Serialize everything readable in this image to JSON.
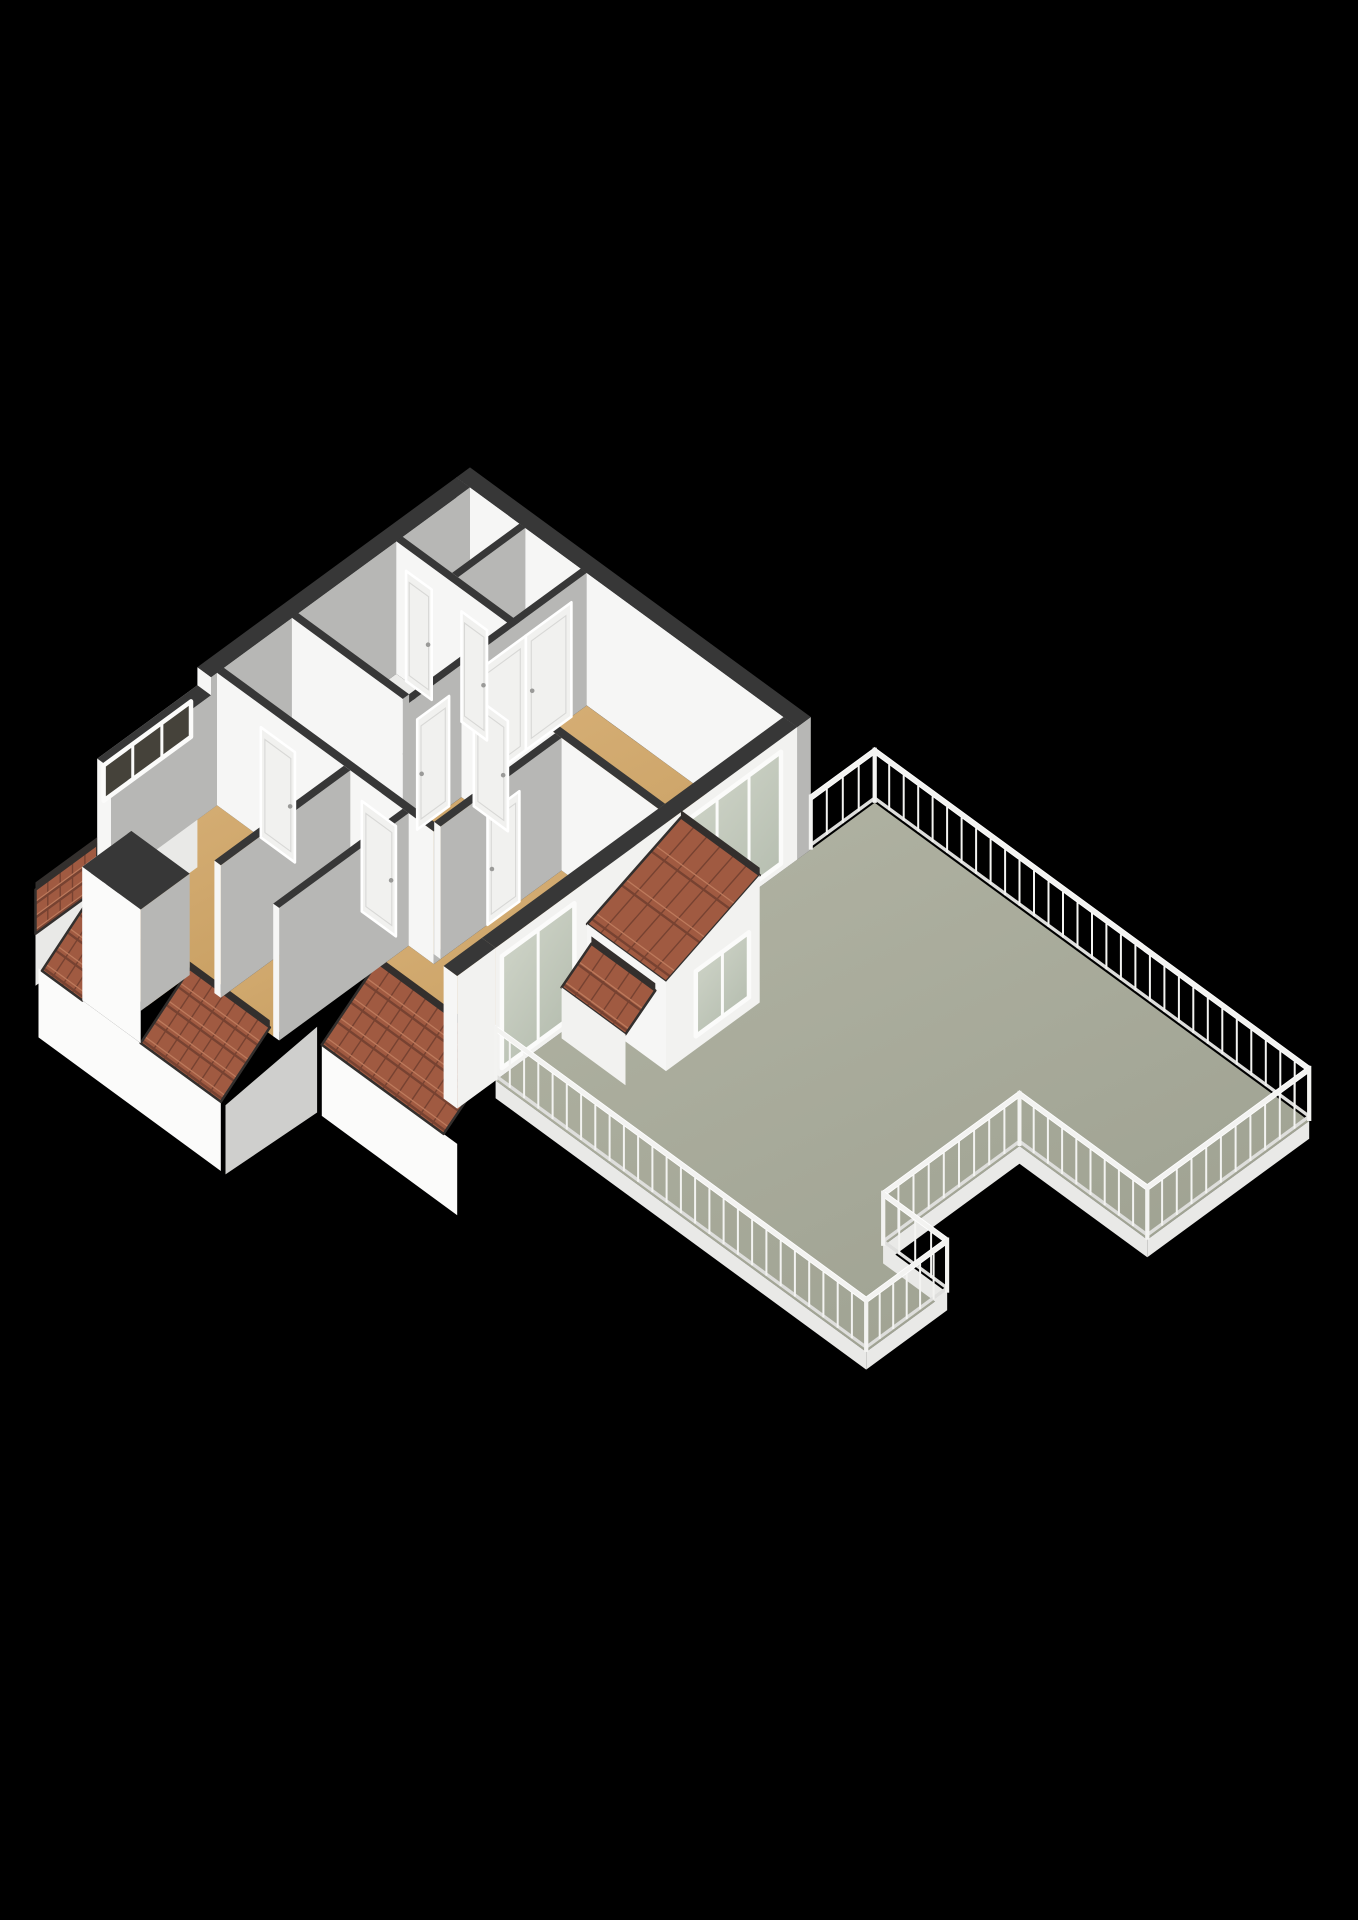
{
  "app": {
    "view_label": "3d-floorplan-render",
    "background": "#000000"
  },
  "projection": {
    "x0": 470,
    "y0": 600,
    "ux": 42.6,
    "uy": 31.2,
    "vz": 52,
    "wall_h": 2.55
  },
  "palette": {
    "bg": "#000000",
    "terrace1": "#b2b4a4",
    "terrace2": "#9fa292",
    "tan1": "#d7b077",
    "tan2": "#c89f62",
    "lightFloor": "#ebebe9",
    "wallTop": "#373737",
    "wallSouth": "#f6f6f5",
    "wallEast": "#b7b7b5",
    "extEast": "#f2f2f0",
    "facadeWhite": "#fbfbfa",
    "facadeGray": "#cfcfcd",
    "fascia": "#e9e9e7",
    "tileBase": "#a05a41",
    "tileDark": "#774231",
    "tileLight": "#bd7a5c",
    "tileTrim": "#332f2d",
    "rail": "#f3f3f1",
    "railShade": "#dededc",
    "glass1": "#d3d8cc",
    "glass2": "#b4bcae",
    "darkGlass": "#45423a",
    "frame": "#fbfbfa",
    "leaf": "#f1f1ef",
    "leafLine": "#d8d8d6",
    "knob": "#9a9a98",
    "hatch": "#f4f4f2",
    "hatchSide": "#dededc",
    "hatchEdge": "#3a3a3a",
    "cubeTop": "#f0f0ee",
    "cubeSouth": "#fafaf8",
    "cubeEast": "#dadad8"
  },
  "terrace": {
    "name": "roof-terrace",
    "outline": [
      [
        8,
        -1.5
      ],
      [
        18.2,
        -1.5
      ],
      [
        18.2,
        2.3
      ],
      [
        15.2,
        2.3
      ],
      [
        15.2,
        5.5
      ],
      [
        16.7,
        5.5
      ],
      [
        16.7,
        7.4
      ],
      [
        8,
        7.4
      ]
    ],
    "fascia_depth": 0.34,
    "fascia_edges": [
      [
        [
          18.2,
          -1.5
        ],
        [
          18.2,
          2.3
        ]
      ],
      [
        [
          18.2,
          2.3
        ],
        [
          15.2,
          2.3
        ]
      ],
      [
        [
          15.2,
          2.3
        ],
        [
          15.2,
          5.5
        ]
      ],
      [
        [
          15.2,
          5.5
        ],
        [
          16.7,
          5.5
        ]
      ],
      [
        [
          16.7,
          5.5
        ],
        [
          16.7,
          7.4
        ]
      ],
      [
        [
          16.7,
          7.4
        ],
        [
          8,
          7.4
        ]
      ]
    ]
  },
  "railing": {
    "spacing": 0.34,
    "z1": 0.94,
    "z2": 1.06,
    "segments": [
      {
        "name": "terrace-railing-nw",
        "a": [
          8,
          -1.5
        ],
        "b": [
          8,
          0
        ]
      },
      {
        "name": "terrace-railing-ne",
        "a": [
          8,
          -1.5
        ],
        "b": [
          18.2,
          -1.5
        ]
      },
      {
        "name": "terrace-railing-east",
        "a": [
          18.2,
          -1.5
        ],
        "b": [
          18.2,
          2.3
        ]
      },
      {
        "name": "terrace-railing-notch-north",
        "a": [
          18.2,
          2.3
        ],
        "b": [
          15.2,
          2.3
        ]
      },
      {
        "name": "terrace-railing-notch-west",
        "a": [
          15.2,
          2.3
        ],
        "b": [
          15.2,
          5.5
        ]
      },
      {
        "name": "terrace-railing-step-north",
        "a": [
          15.2,
          5.5
        ],
        "b": [
          16.7,
          5.5
        ]
      },
      {
        "name": "terrace-railing-step-east",
        "a": [
          16.7,
          5.5
        ],
        "b": [
          16.7,
          7.4
        ]
      },
      {
        "name": "terrace-railing-south",
        "a": [
          16.7,
          7.4
        ],
        "b": [
          8,
          7.4
        ]
      }
    ]
  },
  "floors": [
    {
      "name": "floor-closet-1",
      "color": "lightFloor",
      "rect": [
        0.32,
        0.32,
        1.48,
        1.9
      ]
    },
    {
      "name": "floor-closet-2",
      "color": "lightFloor",
      "rect": [
        1.62,
        0.32,
        2.92,
        1.9
      ]
    },
    {
      "name": "floor-bathroom",
      "color": "lightFloor",
      "rect": [
        0.32,
        2.05,
        2.92,
        4.35
      ]
    },
    {
      "name": "floor-bedroom-ne",
      "color": "tan",
      "rect": [
        3.06,
        0.32,
        7.68,
        3.1
      ]
    },
    {
      "name": "floor-landing",
      "color": "tan",
      "pts": [
        [
          0.32,
          4.5
        ],
        [
          3.06,
          4.5
        ],
        [
          3.06,
          3.26
        ],
        [
          5.26,
          3.26
        ],
        [
          5.26,
          6.1
        ],
        [
          0.32,
          6.1
        ]
      ]
    },
    {
      "name": "floor-bedroom-sw",
      "color": "tan",
      "rect": [
        0.32,
        6.26,
        3.3,
        9.3
      ]
    },
    {
      "name": "floor-dormer-south",
      "color": "tan",
      "rect": [
        1.35,
        9.3,
        2.72,
        10.3
      ]
    },
    {
      "name": "floor-bedroom-smid",
      "color": "tan",
      "rect": [
        3.45,
        6.26,
        4.68,
        9.3
      ]
    },
    {
      "name": "floor-bedroom-se",
      "color": "tan",
      "pts": [
        [
          5.41,
          3.26
        ],
        [
          7.68,
          3.26
        ],
        [
          7.68,
          7.0
        ],
        [
          4.82,
          7.0
        ],
        [
          4.82,
          6.26
        ],
        [
          5.41,
          6.26
        ]
      ]
    }
  ],
  "cube": {
    "name": "storage-unit",
    "rect": [
      1.75,
      0.5,
      2.5,
      1.15
    ],
    "h": 0.8
  },
  "hatch": {
    "name": "stair-hatch",
    "x1": 1.1,
    "y1": 2.3,
    "x2": 2.5,
    "y2": 4.1,
    "zlo": 0.15,
    "zhi": 1.0
  },
  "facades": [
    {
      "name": "facade-west-band-wall",
      "color": "wallSouth",
      "pts": [
        [
          0,
          6.4,
          0
        ],
        [
          0,
          8.75,
          0
        ],
        [
          0,
          8.75,
          2.2
        ],
        [
          0,
          6.4,
          2.2
        ]
      ]
    },
    {
      "name": "facade-west-under-band",
      "color": "fascia",
      "pts": [
        [
          0,
          6.4,
          -1.3
        ],
        [
          0,
          8.75,
          -1.3
        ],
        [
          0,
          8.75,
          0
        ],
        [
          0,
          6.4,
          0
        ]
      ]
    },
    {
      "name": "facade-west-under-tiles",
      "color": "fascia",
      "pts": [
        [
          0,
          8.75,
          -1.3
        ],
        [
          0,
          10.2,
          -1.3
        ],
        [
          0,
          10.2,
          -0.3
        ],
        [
          0,
          8.75,
          -0.3
        ]
      ]
    },
    {
      "name": "facade-south-west",
      "color": "facadeWhite",
      "pts": [
        [
          0.32,
          10.45,
          -0.62
        ],
        [
          4.6,
          10.45,
          -0.62
        ],
        [
          4.6,
          10.45,
          -1.95
        ],
        [
          0.32,
          10.45,
          -1.95
        ]
      ]
    },
    {
      "name": "facade-south-east",
      "color": "facadeWhite",
      "pts": [
        [
          4.82,
          8.3,
          -0.68
        ],
        [
          8.0,
          8.3,
          -0.68
        ],
        [
          8.0,
          8.3,
          -2.05
        ],
        [
          4.82,
          8.3,
          -2.05
        ]
      ]
    },
    {
      "name": "facade-step-side",
      "color": "facadeGray",
      "pts": [
        [
          4.71,
          8.3,
          -0.4
        ],
        [
          4.71,
          10.45,
          -0.62
        ],
        [
          4.71,
          10.45,
          -1.95
        ],
        [
          4.71,
          8.3,
          -2.05
        ]
      ]
    }
  ],
  "roofs": [
    {
      "name": "roof-tiles-west-face",
      "corners": [
        [
          0,
          8.75,
          0.55
        ],
        [
          0,
          10.2,
          0.55
        ],
        [
          0,
          10.2,
          -0.3
        ],
        [
          0,
          8.75,
          -0.3
        ]
      ],
      "rows": 3,
      "cols": 5
    },
    {
      "name": "roof-tiles-sw-left",
      "corners": [
        [
          0.4,
          9.3,
          0.12
        ],
        [
          1.35,
          9.3,
          0.12
        ],
        [
          1.35,
          10.45,
          -0.62
        ],
        [
          0.4,
          10.45,
          -0.62
        ]
      ],
      "rows": 4,
      "cols": 4
    },
    {
      "name": "roof-tiles-sw-right",
      "corners": [
        [
          2.72,
          9.3,
          0.12
        ],
        [
          4.6,
          9.3,
          0.12
        ],
        [
          4.6,
          10.45,
          -0.62
        ],
        [
          2.72,
          10.45,
          -0.62
        ]
      ],
      "rows": 4,
      "cols": 7
    },
    {
      "name": "roof-tiles-se",
      "corners": [
        [
          4.82,
          7.0,
          0.12
        ],
        [
          7.68,
          7.0,
          0.12
        ],
        [
          7.68,
          8.3,
          -0.68
        ],
        [
          4.82,
          8.3,
          -0.68
        ]
      ],
      "rows": 4,
      "cols": 10
    }
  ],
  "walls": [
    {
      "n": "wall-ext-north",
      "x1": 0,
      "y1": 0,
      "x2": 8,
      "y2": 0.32,
      "h": 2.55
    },
    {
      "n": "wall-ext-west-a",
      "x1": 0,
      "y1": 0.32,
      "x2": 0.32,
      "y2": 6.4,
      "h": 2.55
    },
    {
      "n": "wall-ext-west-b",
      "x1": 0,
      "y1": 6.4,
      "x2": 0.32,
      "y2": 8.75,
      "h": 2.2
    },
    {
      "n": "wall-closets-south",
      "x1": 0.32,
      "y1": 1.9,
      "x2": 3.06,
      "y2": 2.05,
      "h": 2.55
    },
    {
      "n": "wall-closets-divider",
      "x1": 1.48,
      "y1": 0.32,
      "x2": 1.62,
      "y2": 1.9,
      "h": 2.55
    },
    {
      "n": "wall-bedroom-ne-west",
      "x1": 2.92,
      "y1": 0.32,
      "x2": 3.06,
      "y2": 4.5,
      "h": 2.55
    },
    {
      "n": "wall-bathroom-south",
      "x1": 0.32,
      "y1": 4.35,
      "x2": 2.92,
      "y2": 4.5,
      "h": 2.55
    },
    {
      "n": "wall-bedroom-ne-south",
      "x1": 3.06,
      "y1": 3.1,
      "x2": 7.68,
      "y2": 3.26,
      "h": 2.55
    },
    {
      "n": "wall-landing-south",
      "x1": 0.32,
      "y1": 6.1,
      "x2": 5.41,
      "y2": 6.26,
      "h": 2.55
    },
    {
      "n": "wall-ext-east",
      "x1": 7.68,
      "y1": 0.32,
      "x2": 8,
      "y2": 7.4,
      "h": 2.55,
      "e": "extEast"
    },
    {
      "n": "wall-landing-east",
      "x1": 5.26,
      "y1": 3.26,
      "x2": 5.41,
      "y2": 6.1,
      "h": 2.55
    },
    {
      "n": "wall-sw-divider",
      "x1": 3.3,
      "y1": 6.26,
      "x2": 3.45,
      "y2": 9.3,
      "h": 2.55
    },
    {
      "n": "wall-mid-divider",
      "x1": 4.68,
      "y1": 6.26,
      "x2": 4.82,
      "y2": 9.3,
      "h": 2.55
    },
    {
      "n": "wall-se-corner-stub",
      "x1": 7.68,
      "y1": 7.4,
      "x2": 8,
      "y2": 8.3,
      "h": 2.55,
      "e": "extEast"
    }
  ],
  "openings": [
    {
      "n": "window-bedroom-terrace-glazing",
      "type": "window",
      "plane": "x",
      "c": 8,
      "a1": 0.7,
      "a2": 2.95,
      "z1": 0.15,
      "z2": 2.3,
      "panes": 3
    },
    {
      "n": "window-se-room-terrace-glazing",
      "type": "window",
      "plane": "x",
      "c": 8,
      "a1": 5.55,
      "a2": 7.25,
      "z1": 0.15,
      "z2": 2.3,
      "panes": 2
    },
    {
      "n": "window-west-band",
      "type": "window",
      "plane": "x",
      "c": 0,
      "a1": 6.55,
      "a2": 8.6,
      "z1": 1.3,
      "z2": 1.98,
      "panes": 3,
      "dark": true
    },
    {
      "n": "closet-double-doors",
      "type": "double",
      "plane": "x",
      "c": 3.06,
      "a1": 0.68,
      "a2": 2.82,
      "z1": 0,
      "z2": 2.2
    },
    {
      "n": "door-bathroom",
      "type": "door",
      "plane": "x",
      "c": 3.06,
      "a1": 3.55,
      "a2": 4.3,
      "z1": 0,
      "z2": 2.12
    },
    {
      "n": "door-se-room",
      "type": "door",
      "plane": "x",
      "c": 5.41,
      "a1": 4.25,
      "a2": 5.0,
      "z1": 0,
      "z2": 2.12
    },
    {
      "n": "door-bedroom-ne",
      "type": "door",
      "plane": "y",
      "c": 3.26,
      "a1": 3.35,
      "a2": 4.15,
      "z1": 0,
      "z2": 2.12
    },
    {
      "n": "door-bedroom-sw",
      "type": "door",
      "plane": "y",
      "c": 6.26,
      "a1": 1.35,
      "a2": 2.15,
      "z1": 0,
      "z2": 2.12
    },
    {
      "n": "door-bedroom-smid",
      "type": "door",
      "plane": "y",
      "c": 6.26,
      "a1": 3.72,
      "a2": 4.52,
      "z1": 0,
      "z2": 2.12
    },
    {
      "n": "door-closet-1",
      "type": "door",
      "plane": "y",
      "c": 2.05,
      "a1": 0.55,
      "a2": 1.15,
      "z1": 0,
      "z2": 2.12
    },
    {
      "n": "door-closet-2",
      "type": "door",
      "plane": "y",
      "c": 2.05,
      "a1": 1.85,
      "a2": 2.45,
      "z1": 0,
      "z2": 2.12
    }
  ],
  "dormers": [
    {
      "name": "dormer-south",
      "parts": [
        {
          "t": "face",
          "color": "wallSouth",
          "pts": [
            [
              1.35,
              9.3,
              0
            ],
            [
              1.35,
              10.45,
              0
            ],
            [
              1.35,
              10.45,
              1.95
            ],
            [
              1.35,
              9.3,
              1.95
            ]
          ]
        },
        {
          "t": "window",
          "plane": "x",
          "c": 1.35,
          "a1": 9.55,
          "a2": 10.3,
          "z1": 0.3,
          "z2": 1.8,
          "panes": 2,
          "dark": true
        },
        {
          "t": "face",
          "color": "facadeWhite",
          "pts": [
            [
              1.35,
              10.45,
              -0.62
            ],
            [
              2.72,
              10.45,
              -0.62
            ],
            [
              2.72,
              10.45,
              1.95
            ],
            [
              1.35,
              10.45,
              1.95
            ]
          ]
        },
        {
          "t": "face",
          "color": "wallEast",
          "pts": [
            [
              2.72,
              9.3,
              0
            ],
            [
              2.72,
              10.45,
              0
            ],
            [
              2.72,
              10.45,
              1.95
            ],
            [
              2.72,
              9.3,
              1.95
            ]
          ]
        },
        {
          "t": "face",
          "color": "wallTop",
          "pts": [
            [
              1.35,
              9.3,
              1.95
            ],
            [
              2.72,
              9.3,
              1.95
            ],
            [
              2.72,
              10.45,
              1.95
            ],
            [
              1.35,
              10.45,
              1.95
            ]
          ]
        }
      ]
    },
    {
      "name": "dormer-terrace-east",
      "parts": [
        {
          "t": "roof",
          "corners": [
            [
              8,
              3.05,
              2.45
            ],
            [
              9.85,
              3.05,
              2.45
            ],
            [
              9.85,
              5.25,
              1.72
            ],
            [
              8,
              5.25,
              1.72
            ]
          ],
          "rows": 3,
          "cols": 6
        },
        {
          "t": "face",
          "color": "extEast",
          "pts": [
            [
              9.85,
              3.05,
              0
            ],
            [
              9.85,
              5.25,
              0
            ],
            [
              9.85,
              5.25,
              1.72
            ],
            [
              9.85,
              3.05,
              2.45
            ]
          ]
        },
        {
          "t": "window",
          "plane": "x",
          "c": 9.85,
          "a1": 3.3,
          "a2": 4.55,
          "z1": 0.25,
          "z2": 1.5,
          "panes": 2
        },
        {
          "t": "face",
          "color": "wallSouth",
          "pts": [
            [
              8,
              5.25,
              0
            ],
            [
              9.85,
              5.25,
              0
            ],
            [
              9.85,
              5.25,
              1.72
            ],
            [
              8,
              5.25,
              1.72
            ]
          ]
        },
        {
          "t": "roof",
          "corners": [
            [
              8.1,
              5.25,
              1.4
            ],
            [
              9.6,
              5.25,
              1.4
            ],
            [
              9.6,
              5.95,
              0.98
            ],
            [
              8.1,
              5.95,
              0.98
            ]
          ],
          "rows": 2,
          "cols": 5
        },
        {
          "t": "face",
          "color": "extEast",
          "pts": [
            [
              8.1,
              5.95,
              0
            ],
            [
              9.6,
              5.95,
              0
            ],
            [
              9.6,
              5.95,
              0.98
            ],
            [
              8.1,
              5.95,
              0.98
            ]
          ]
        }
      ]
    }
  ]
}
